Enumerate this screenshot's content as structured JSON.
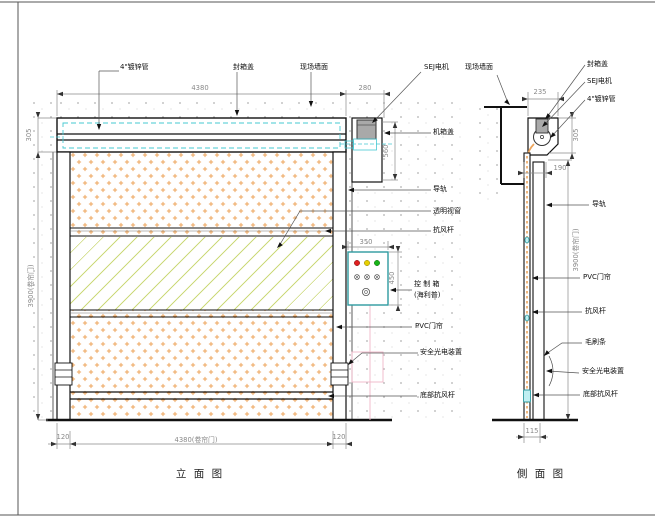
{
  "drawing": {
    "front_view": {
      "caption": "立 面 图",
      "labels": {
        "pipe": "4\"镀锌管",
        "seal_cover": "封箱盖",
        "wall": "现场墙面",
        "motor": "SEJ电机",
        "machine_cover": "机箱盖",
        "rail": "导轨",
        "window": "透明视窗",
        "wind_bar": "抗风杆",
        "control_line1": "控 制 箱",
        "control_line2": "(海利普)",
        "curtain": "PVC门帘",
        "photocell": "安全光电装置",
        "bottom_bar": "底部抗风杆"
      },
      "dims": {
        "top_width": "4380",
        "side_offset": "280",
        "lintel_height": "305",
        "door_height": "3900(卷帘门)",
        "motor_box_height": "560",
        "control_width": "350",
        "control_height": "450",
        "col_left": "120",
        "bottom_width": "4380(卷帘门)",
        "col_right": "120"
      }
    },
    "side_view": {
      "caption": "側 面 图",
      "labels": {
        "wall": "现场墙面",
        "seal_cover": "封箱盖",
        "motor": "SEJ电机",
        "pipe": "4\"镀锌管",
        "rail": "导轨",
        "curtain": "PVC门帘",
        "wind_bar": "抗风杆",
        "brush": "毛刷条",
        "photocell": "安全光电装置",
        "bottom_bar": "底部抗风杆"
      },
      "dims": {
        "bracket_width": "235",
        "lintel_height": "305",
        "rail_depth": "190",
        "door_height": "3900(卷帘门)",
        "slab": "115"
      }
    },
    "colors": {
      "curtain_dots": "#eda55c",
      "window_hatch": "#ccd97a",
      "hidden_roller_cyan": "#46c8d2",
      "control_border": "#2e9aa0",
      "light_red": "#e02020",
      "light_yellow": "#e6cf00",
      "light_green": "#18b418",
      "conduit_pink": "#f0b6c8"
    }
  }
}
